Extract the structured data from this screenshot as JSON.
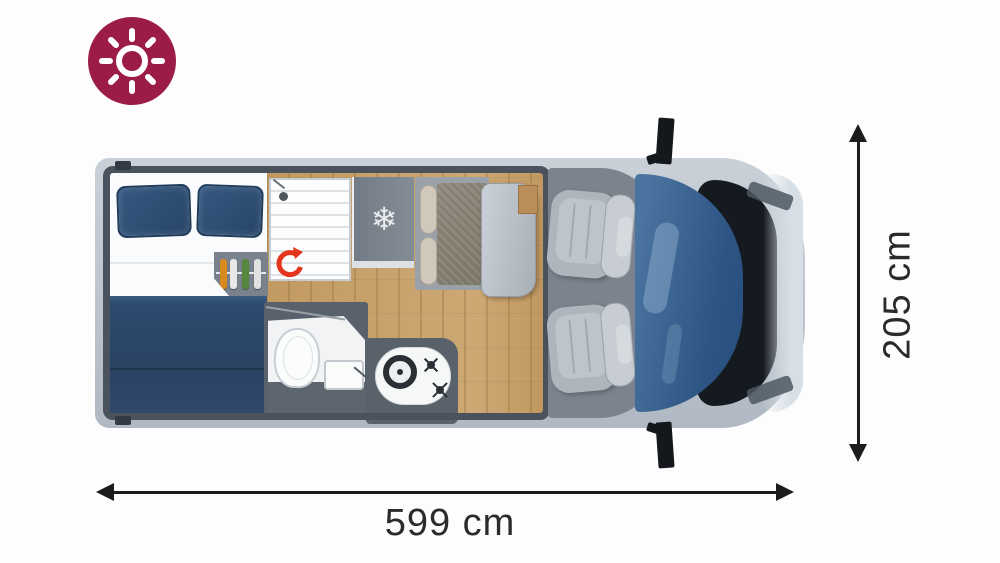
{
  "badge": {
    "icon": "sun-icon",
    "bg_color": "#9B1D46"
  },
  "dimensions": {
    "length_label": "599 cm",
    "width_label": "205 cm"
  },
  "icons": {
    "snowflake_glyph": "❄"
  },
  "colors": {
    "accent_red": "#E4361C",
    "bed_navy": "#2E4D71",
    "wood": "#C7A26C",
    "van_body": "#C2CAD3",
    "windshield_blue": "#3C6898",
    "cab_gray": "#7B838D",
    "wall_dark": "#49525D",
    "badge": "#9B1D46"
  }
}
